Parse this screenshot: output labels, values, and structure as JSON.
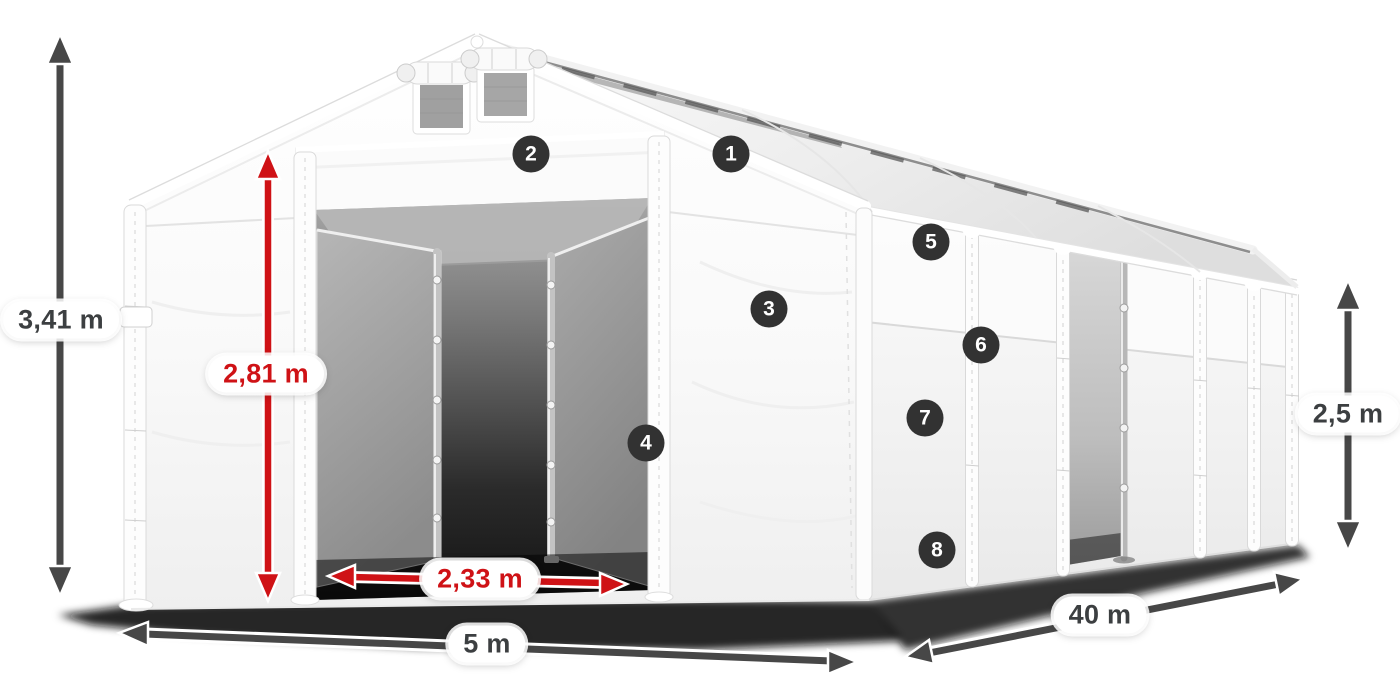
{
  "diagram": {
    "dimension_labels": {
      "total_height": "3,41 m",
      "entrance_height": "2,81 m",
      "entrance_width": "2,33 m",
      "front_width": "5 m",
      "length": "40 m",
      "side_wall_height": "2,5 m"
    },
    "feature_markers": [
      "1",
      "2",
      "3",
      "4",
      "5",
      "6",
      "7",
      "8"
    ],
    "colors": {
      "canvas_bg": "#ffffff",
      "highlight_red": "#cf1216",
      "arrow_gray": "#474747",
      "marker_bg": "#323232",
      "label_text": "#3c3f41"
    }
  }
}
